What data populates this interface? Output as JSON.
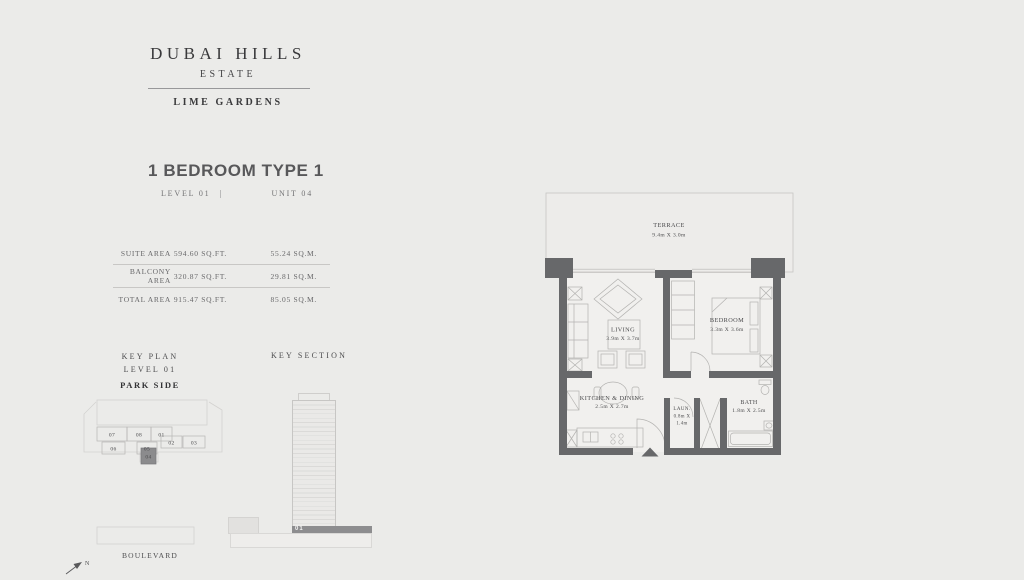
{
  "colors": {
    "background": "#ebebe9",
    "wall": "#67686a",
    "light_line": "#c7c6c4",
    "text_dark": "#3d3d3f",
    "text_muted": "#6f6f71",
    "highlight": "#8b8b8d"
  },
  "brand": {
    "line1": "DUBAI HILLS",
    "line2": "ESTATE",
    "project": "LIME GARDENS"
  },
  "unit": {
    "title": "1 BEDROOM TYPE 1",
    "level_label": "LEVEL 01",
    "separator": "|",
    "unit_label": "UNIT 04"
  },
  "areas": {
    "rows": [
      {
        "label": "SUITE AREA",
        "sqft": "594.60 SQ.FT.",
        "sqm": "55.24 SQ.M."
      },
      {
        "label": "BALCONY AREA",
        "sqft": "320.87 SQ.FT.",
        "sqm": "29.81 SQ.M."
      },
      {
        "label": "TOTAL AREA",
        "sqft": "915.47 SQ.FT.",
        "sqm": "85.05 SQ.M."
      }
    ]
  },
  "key_plan": {
    "heading_line1": "KEY PLAN",
    "heading_line2": "LEVEL 01",
    "park_side_label": "PARK SIDE",
    "boulevard_label": "BOULEVARD",
    "north_label": "N",
    "units": [
      "07",
      "08",
      "01",
      "06",
      "05",
      "02",
      "03"
    ],
    "highlighted_unit": "04"
  },
  "key_section": {
    "heading": "KEY SECTION",
    "highlighted_floor_label": "01"
  },
  "floor_plan": {
    "rooms": [
      {
        "name": "TERRACE",
        "dims": "9.4m X 3.0m"
      },
      {
        "name": "LIVING",
        "dims": "3.9m X 3.7m"
      },
      {
        "name": "BEDROOM",
        "dims": "3.3m X 3.6m"
      },
      {
        "name": "KITCHEN & DINING",
        "dims": "2.5m X 2.7m"
      },
      {
        "name": "LAUN.",
        "dims_line1": "0.8m X",
        "dims_line2": "1.4m"
      },
      {
        "name": "BATH",
        "dims": "1.8m X 2.5m"
      }
    ]
  }
}
